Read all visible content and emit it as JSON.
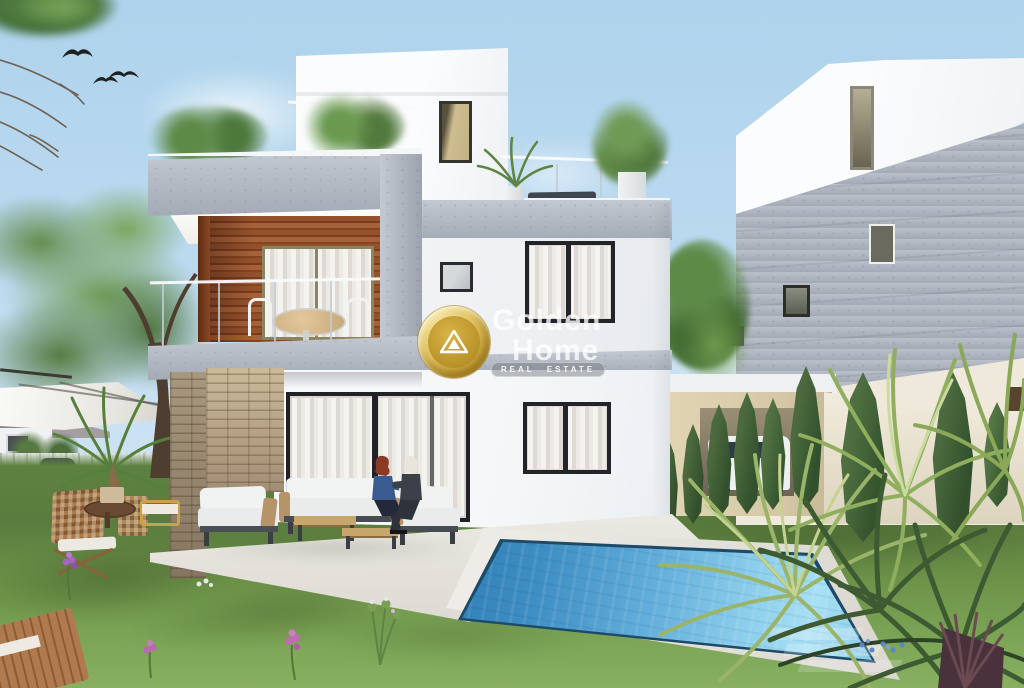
{
  "watermark": {
    "brand_top": "Golden",
    "brand_bottom": "Home",
    "tagline": "Real Estate",
    "logo_icon": "house-triangle-in-gold-circle",
    "gold_color": "#d7b54a",
    "text_color": "#ffffff"
  },
  "scene": {
    "type": "3D architectural exterior rendering",
    "subject": "Modern three-storey white villa with timber balcony accent, rooftop terrace, swimming pool and landscaped garden",
    "sky": "clear light blue sky with soft clouds and three flying birds",
    "left_garden": [
      "white cantilever parasol",
      "wooden folding chairs",
      "round wooden side table",
      "potted palm",
      "lawn with purple flowers",
      "wooden sun lounger",
      "white fence and small houses in background"
    ],
    "villa": [
      "rooftop terrace with potted plants, lounger and glass railing",
      "timber-clad balcony with round table and white chairs",
      "glass balustrade",
      "grey concrete slabs",
      "stone-clad pillar",
      "sliding glass doors with white curtains",
      "dark framed windows"
    ],
    "patio": [
      "white cushion lounge set with timber arms",
      "two nesting coffee tables",
      "two seated women reviewing documents"
    ],
    "pool": "blue tiled swimming pool with white coping and steps",
    "right_side": [
      "neighbouring white and grey concrete building",
      "carport with white pickup truck",
      "row of dark cypress trees",
      "cream boundary wall",
      "yucca and fan palm plants",
      "small blue flowers"
    ],
    "counts": {
      "birds": 3,
      "people": 2,
      "cypress_trees": 9
    },
    "palette": {
      "sky": "#b7d7ec",
      "wall_white": "#f5f6f8",
      "concrete_grey": "#aeb6c2",
      "timber": "#9a512b",
      "stone": "#bfae92",
      "pool_water": "#5aa5d4",
      "grass": "#6d9349",
      "cypress": "#3d5a33",
      "curtain": "#efece7",
      "gold": "#d7b54a"
    }
  }
}
